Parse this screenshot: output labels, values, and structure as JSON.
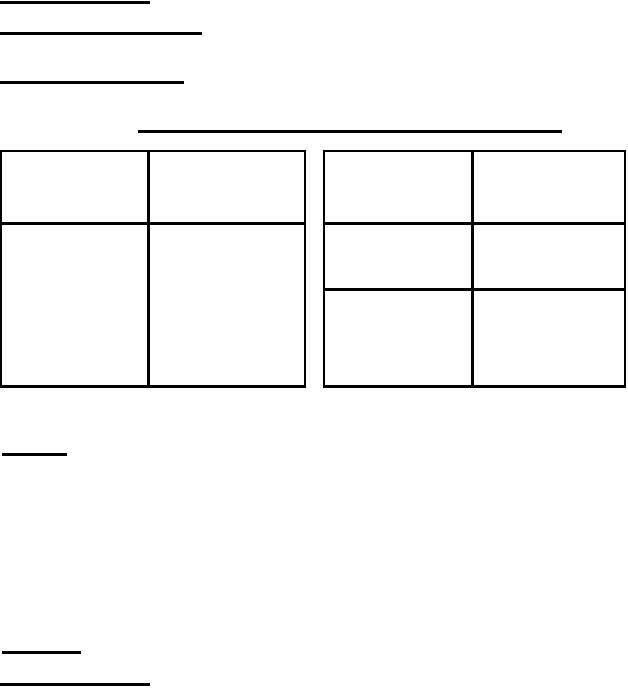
{
  "page": {
    "background_color": "#ffffff",
    "ink_color": "#000000"
  },
  "header_blanks": {
    "line_1": "",
    "line_2": "",
    "line_3": ""
  },
  "title_blank": {
    "text": ""
  },
  "left_table": {
    "rows": 2,
    "columns": 2,
    "cells": [
      [
        "",
        ""
      ],
      [
        "",
        ""
      ]
    ]
  },
  "right_table": {
    "rows": 3,
    "columns": 2,
    "cells": [
      [
        "",
        ""
      ],
      [
        "",
        ""
      ],
      [
        "",
        ""
      ]
    ]
  },
  "section_blank": {
    "text": ""
  },
  "footer_blanks": {
    "line_1": "",
    "line_2": ""
  }
}
